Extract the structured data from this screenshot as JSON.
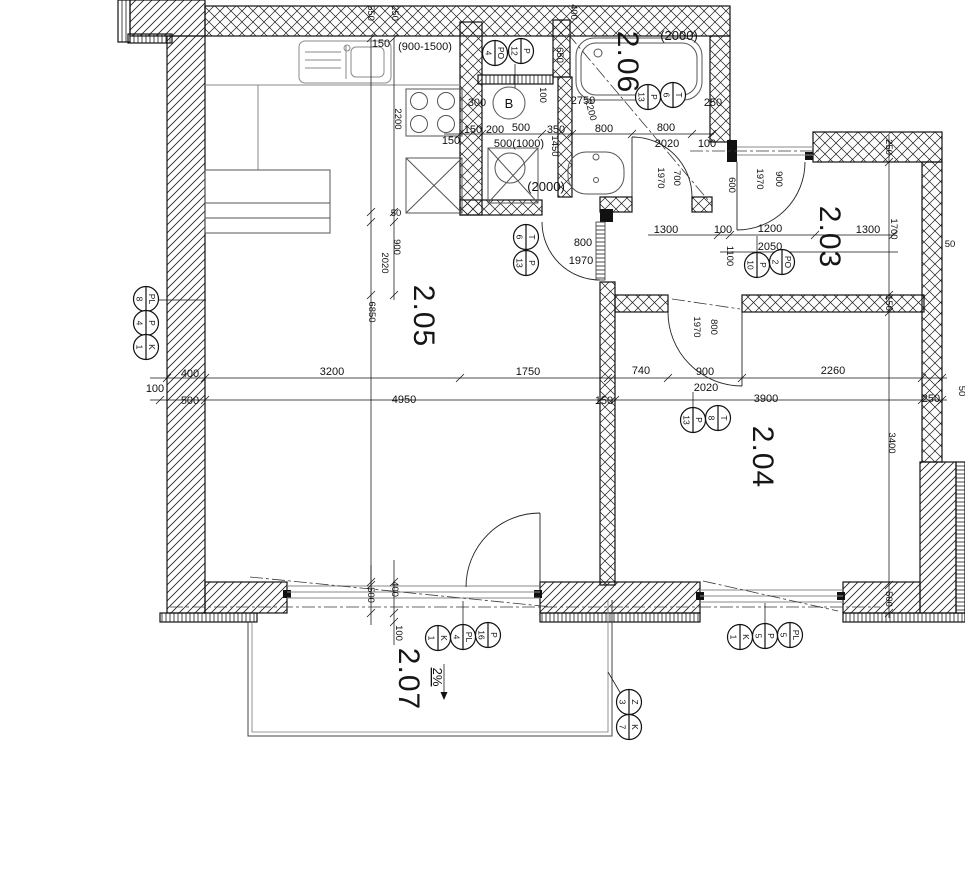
{
  "rooms": {
    "living": "2.05",
    "bath": "2.06",
    "hall": "2.03",
    "bedroom": "2.04",
    "terrace": "2.07"
  },
  "labels": {
    "boiler": "B",
    "counter_range": "(900-1500)",
    "tub_length": "(2000)",
    "shower_length": "(2000)",
    "wc_width": "500(1000)",
    "slope": "2%"
  },
  "dims": {
    "top": {
      "d550": "550",
      "d250": "250",
      "d400": "400",
      "d150": "150"
    },
    "kitchen": {
      "d2200": "2200",
      "d50": "50",
      "d900": "900",
      "d2020": "2020",
      "d6850": "6850"
    },
    "bath": {
      "d650": "650",
      "d2750": "2750",
      "d2200": "2200",
      "d100": "100",
      "d300": "300",
      "d250": "250",
      "row150a": "150",
      "row150b": "150",
      "row200": "200",
      "row500": "500",
      "row350": "350",
      "row800a": "800",
      "row800b": "800",
      "row2020": "2020",
      "row100": "100",
      "d1450": "1450"
    },
    "bathdoor": {
      "w": "700",
      "h": "1970"
    },
    "halldoor": {
      "w": "900",
      "h": "1970"
    },
    "livdoor": {
      "w": "800",
      "h": "1970"
    },
    "beddoor": {
      "w": "800",
      "h": "1970"
    },
    "hall": {
      "d600": "600",
      "d1300a": "1300",
      "d100": "100",
      "d1200": "1200",
      "d2050": "2050",
      "d1300b": "1300",
      "d1700": "1700",
      "d1100": "1100",
      "d250": "250",
      "d50": "50"
    },
    "main": {
      "d400": "400",
      "d3200": "3200",
      "d1750": "1750",
      "d740": "740",
      "d900": "900",
      "d2020": "2020",
      "d2260": "2260",
      "d100": "100",
      "d500": "500",
      "d4950": "4950",
      "d150": "150",
      "d3900": "3900",
      "d250": "250",
      "d50": "50"
    },
    "right": {
      "d150": "150",
      "d3400": "3400",
      "d500": "500"
    },
    "bottom": {
      "d500": "500",
      "d400": "400",
      "d100": "100"
    }
  },
  "markers": {
    "left": [
      {
        "code": "PL",
        "num": "8"
      },
      {
        "code": "P",
        "num": "4"
      },
      {
        "code": "K",
        "num": "1"
      }
    ],
    "closet": [
      {
        "code": "PO",
        "num": "4"
      },
      {
        "code": "P",
        "num": "12"
      }
    ],
    "bath": [
      {
        "code": "P",
        "num": "13"
      },
      {
        "code": "T",
        "num": "6"
      }
    ],
    "livdoor": [
      {
        "code": "T",
        "num": "6"
      },
      {
        "code": "P",
        "num": "13"
      }
    ],
    "hall": [
      {
        "code": "P",
        "num": "10"
      },
      {
        "code": "PO",
        "num": "2"
      }
    ],
    "bedroom": [
      {
        "code": "P",
        "num": "13"
      },
      {
        "code": "T",
        "num": "8"
      }
    ],
    "window1": [
      {
        "code": "K",
        "num": "1"
      },
      {
        "code": "PL",
        "num": "4"
      },
      {
        "code": "P",
        "num": "16"
      }
    ],
    "window2": [
      {
        "code": "K",
        "num": "1"
      },
      {
        "code": "P",
        "num": "5"
      },
      {
        "code": "PL",
        "num": "5"
      }
    ],
    "terrace": [
      {
        "code": "Z",
        "num": "3"
      },
      {
        "code": "K",
        "num": "7"
      }
    ]
  }
}
